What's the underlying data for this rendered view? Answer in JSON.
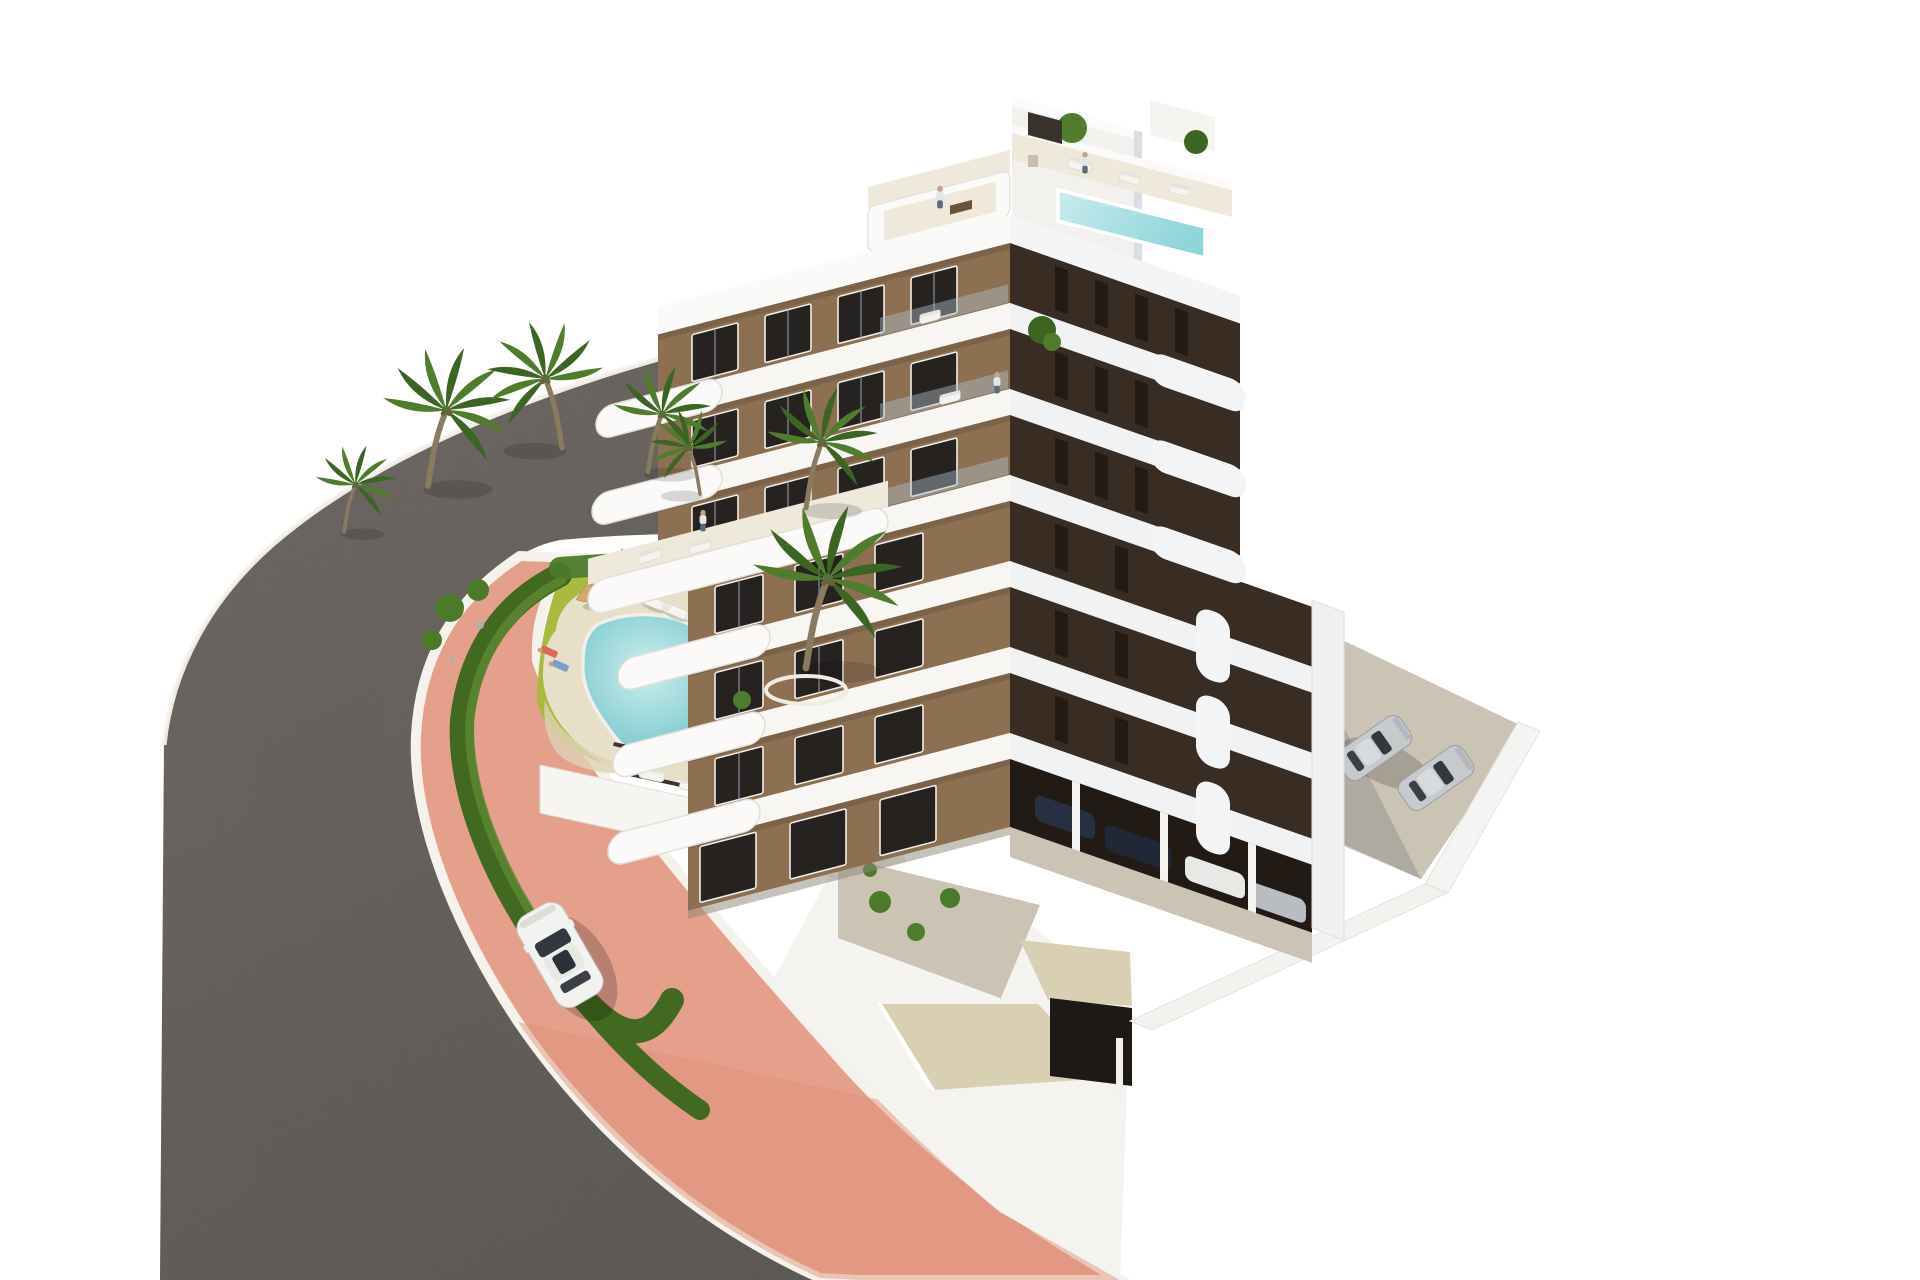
{
  "scene": {
    "type": "architectural-3d-rendering",
    "subject": "modern-apartment-building-with-garden-pool-and-parking",
    "objects": {
      "palm_trees": 7,
      "sun_loungers": 5,
      "parasols": 3,
      "garden_pool": 1,
      "rooftop_pool": 1,
      "car_on_road": 1,
      "cars_side_parking": 2,
      "cars_under_building": 4,
      "people_visible": 9,
      "building_floors_visible": 8
    }
  },
  "colors": {
    "background": "#ffffff",
    "asphalt": "#7b7570",
    "asphalt_dark": "#6c6763",
    "curb": "#f5f2ec",
    "sidewalk": "#e5a08c",
    "sidewalk_deep": "#dd8d76",
    "hedge": "#41691f",
    "hedge_light": "#5d8a33",
    "grass": "#a9ba40",
    "grass_light": "#c0cb52",
    "shrub": "#4c7a2b",
    "rock": "#b5aea3",
    "sand": "#e8dfc8",
    "pool_water": "#84cdd2",
    "pool_shallow": "#c9ecec",
    "rooftop_pool": "#aadfe3",
    "building_white": "#f7f6f3",
    "building_shade": "#dce1e7",
    "facade_left": "#8d7052",
    "facade_left_dark": "#6e5740",
    "facade_right": "#382c23",
    "facade_right_dark": "#221b15",
    "window_dark": "#262220",
    "floor_cream": "#efe9dc",
    "concrete": "#cbc4b5",
    "driveway": "#d9cfb3",
    "ramp_dark": "#1c1916",
    "car_white": "#f2f2f0",
    "car_silver": "#c7cacd",
    "car_dark": "#273040",
    "glass": "#32383e",
    "trunk": "#8a7a5f",
    "palm_green": "#507c2e",
    "palm_green_dark": "#3c6524",
    "umbrella": "#d2a96f",
    "skin": "#c9a186",
    "shadow": "#5a5a64"
  }
}
